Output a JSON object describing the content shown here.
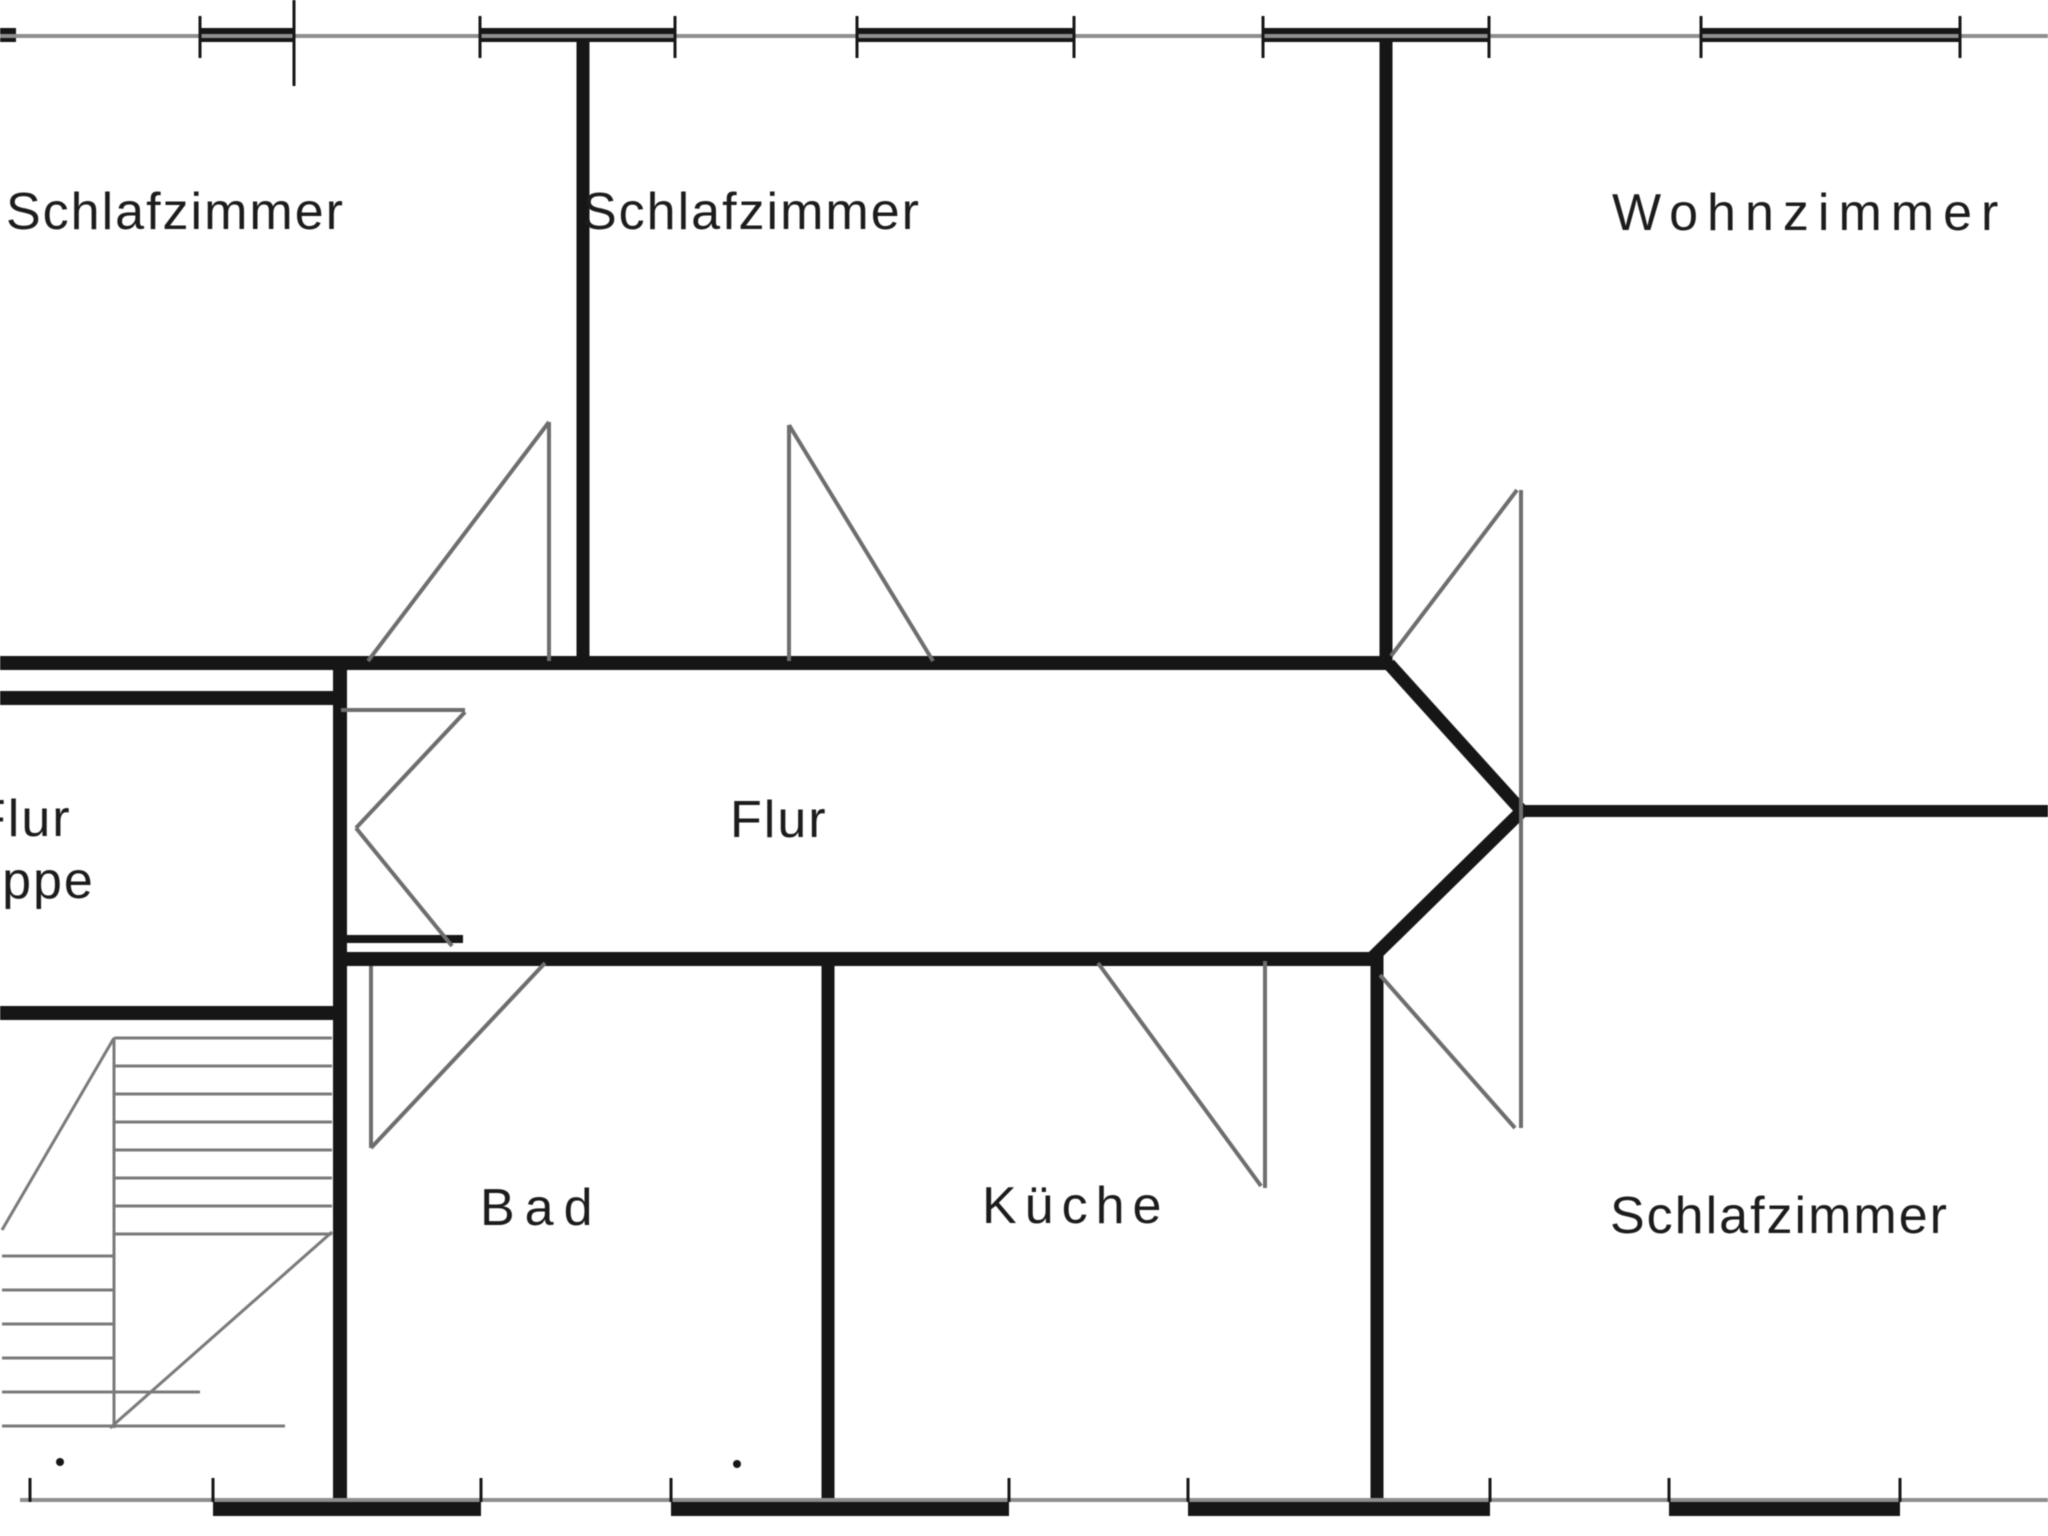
{
  "title": "Grundriss (apartment floor plan)",
  "drawing_type": "architectural floor plan, scanned black-and-white",
  "colors": {
    "background": "#ffffff",
    "wall": "#161616",
    "thin": "#8e8e8e",
    "door": "#6e6e6e",
    "stair": "#7a7a7a",
    "text": "#1c1c1c"
  },
  "rooms": {
    "schlafzimmer_nw": {
      "label": "Schlafzimmer"
    },
    "schlafzimmer_n": {
      "label": "Schlafzimmer"
    },
    "wohnzimmer": {
      "label": "Wohnzimmer"
    },
    "flur": {
      "label": "Flur"
    },
    "flur_left": {
      "label": "Flur"
    },
    "treppe": {
      "label": "Treppe"
    },
    "bad": {
      "label": "Bad"
    },
    "kueche": {
      "label": "Küche"
    },
    "schlafzimmer_s": {
      "label": "Schlafzimmer"
    }
  },
  "geometry": {
    "canvas": {
      "w": 2048,
      "h": 1536
    },
    "layers": [
      {
        "name": "exterior-walls",
        "color": "wall",
        "width": 14,
        "crisp": true,
        "lines": [
          [
            0,
            35,
            16,
            35
          ],
          [
            200,
            35,
            294,
            35
          ],
          [
            480,
            35,
            675,
            35
          ],
          [
            857,
            35,
            1074,
            35
          ],
          [
            1263,
            35,
            1489,
            35
          ],
          [
            1701,
            35,
            1960,
            35
          ],
          [
            213,
            1509,
            481,
            1509
          ],
          [
            671,
            1509,
            1009,
            1509
          ],
          [
            1188,
            1509,
            1490,
            1509
          ],
          [
            1669,
            1509,
            1900,
            1509
          ]
        ]
      },
      {
        "name": "interior-walls",
        "color": "wall",
        "width": 14,
        "crisp": true,
        "lines": [
          [
            0,
            663,
            1390,
            663
          ],
          [
            0,
            698,
            346,
            698
          ],
          [
            0,
            1013,
            346,
            1013
          ],
          [
            334,
            959,
            1377,
            959
          ],
          [
            334,
            939,
            463,
            939,
            8
          ],
          [
            1518,
            811,
            2048,
            811,
            12
          ],
          [
            583,
            28,
            583,
            663,
            13
          ],
          [
            1386,
            28,
            1386,
            664,
            13
          ],
          [
            340,
            656,
            340,
            1516
          ],
          [
            828,
            959,
            828,
            1516,
            13
          ],
          [
            1377,
            955,
            1377,
            1516,
            13
          ]
        ]
      },
      {
        "name": "corridor-funnel-walls",
        "color": "wall",
        "width": 13,
        "crisp": false,
        "lines": [
          [
            1389,
            664,
            1521,
            810
          ],
          [
            1372,
            958,
            1521,
            812
          ]
        ]
      },
      {
        "name": "window-sill-lines",
        "color": "thin",
        "width": 4,
        "crisp": true,
        "lines": [
          [
            0,
            36,
            2048,
            36
          ],
          [
            20,
            1500,
            2048,
            1500
          ]
        ]
      },
      {
        "name": "window-ticks",
        "color": "wall",
        "width": 3,
        "crisp": true,
        "lines": [
          [
            200,
            16,
            200,
            58
          ],
          [
            480,
            16,
            480,
            58
          ],
          [
            675,
            16,
            675,
            58
          ],
          [
            857,
            16,
            857,
            58
          ],
          [
            1074,
            16,
            1074,
            58
          ],
          [
            1263,
            16,
            1263,
            58
          ],
          [
            1489,
            16,
            1489,
            58
          ],
          [
            1701,
            16,
            1701,
            58
          ],
          [
            1960,
            16,
            1960,
            58
          ],
          [
            294,
            0,
            294,
            86
          ],
          [
            30,
            1478,
            30,
            1502
          ],
          [
            213,
            1478,
            213,
            1502
          ],
          [
            481,
            1478,
            481,
            1502
          ],
          [
            671,
            1478,
            671,
            1502
          ],
          [
            1009,
            1478,
            1009,
            1502
          ],
          [
            1188,
            1478,
            1188,
            1502
          ],
          [
            1490,
            1478,
            1490,
            1502
          ],
          [
            1669,
            1478,
            1669,
            1502
          ],
          [
            1900,
            1478,
            1900,
            1502
          ]
        ]
      },
      {
        "name": "door-symbols",
        "color": "door",
        "width": 4,
        "crisp": false,
        "lines": [
          [
            549,
            422,
            549,
            661
          ],
          [
            549,
            422,
            368,
            661
          ],
          [
            789,
            425,
            789,
            661
          ],
          [
            789,
            425,
            933,
            661
          ],
          [
            1391,
            656,
            1517,
            490
          ],
          [
            1521,
            490,
            1521,
            1128
          ],
          [
            1380,
            975,
            1515,
            1128
          ],
          [
            371,
            966,
            371,
            1148
          ],
          [
            371,
            1148,
            545,
            963
          ],
          [
            1265,
            961,
            1265,
            1188
          ],
          [
            1098,
            963,
            1261,
            1186
          ],
          [
            465,
            712,
            356,
            828
          ],
          [
            356,
            828,
            452,
            946
          ],
          [
            341,
            710,
            465,
            710
          ]
        ]
      },
      {
        "name": "staircase-symbol",
        "color": "stair",
        "width": 3,
        "crisp": false,
        "lines": [
          [
            114,
            1038,
            114,
            1428
          ],
          [
            114,
            1038,
            332,
            1038
          ],
          [
            114,
            1066,
            332,
            1066
          ],
          [
            114,
            1094,
            332,
            1094
          ],
          [
            114,
            1122,
            332,
            1122
          ],
          [
            114,
            1150,
            332,
            1150
          ],
          [
            114,
            1178,
            332,
            1178
          ],
          [
            114,
            1206,
            332,
            1206
          ],
          [
            114,
            1234,
            332,
            1234
          ],
          [
            2,
            1256,
            114,
            1256
          ],
          [
            2,
            1290,
            114,
            1290
          ],
          [
            2,
            1324,
            114,
            1324
          ],
          [
            2,
            1358,
            114,
            1358
          ],
          [
            2,
            1392,
            200,
            1392
          ],
          [
            2,
            1426,
            285,
            1426
          ],
          [
            2,
            1230,
            114,
            1038
          ],
          [
            332,
            1232,
            110,
            1428
          ]
        ]
      }
    ],
    "dots": [
      [
        60,
        1462,
        4
      ],
      [
        737,
        1464,
        4
      ]
    ]
  }
}
